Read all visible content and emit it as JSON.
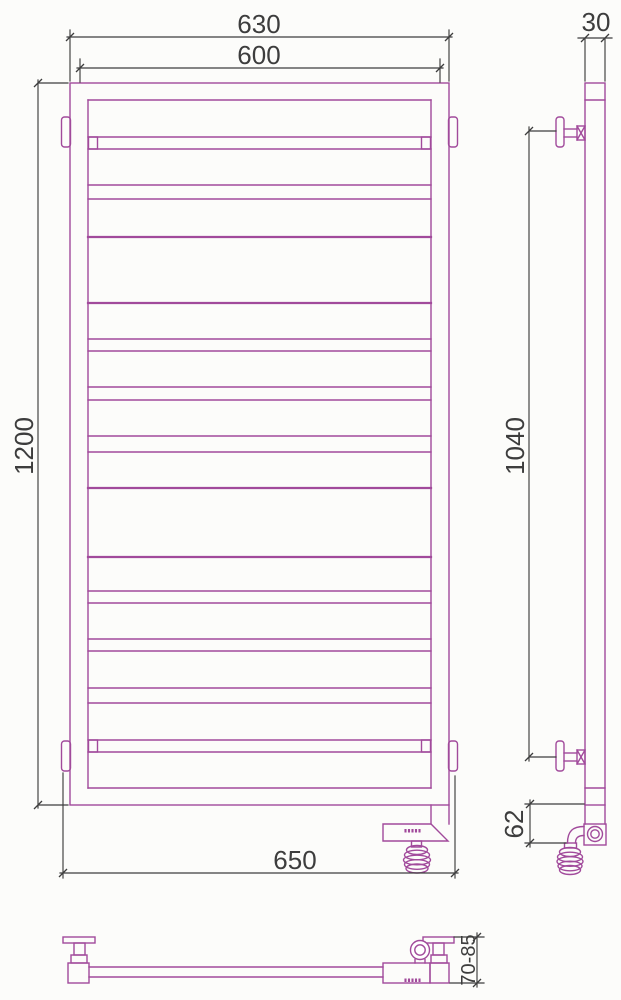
{
  "drawing": {
    "dimensions": {
      "overall_width": "630",
      "rail_width": "600",
      "overall_height": "1200",
      "mounting_width": "650",
      "tube_depth": "30",
      "bracket_spacing": "1040",
      "element_height": "62",
      "wall_offset": "70-85"
    },
    "colors": {
      "product_line": "#A14A9B",
      "dimension_line": "#3D3D3D",
      "background": "#FCFCFA"
    }
  }
}
